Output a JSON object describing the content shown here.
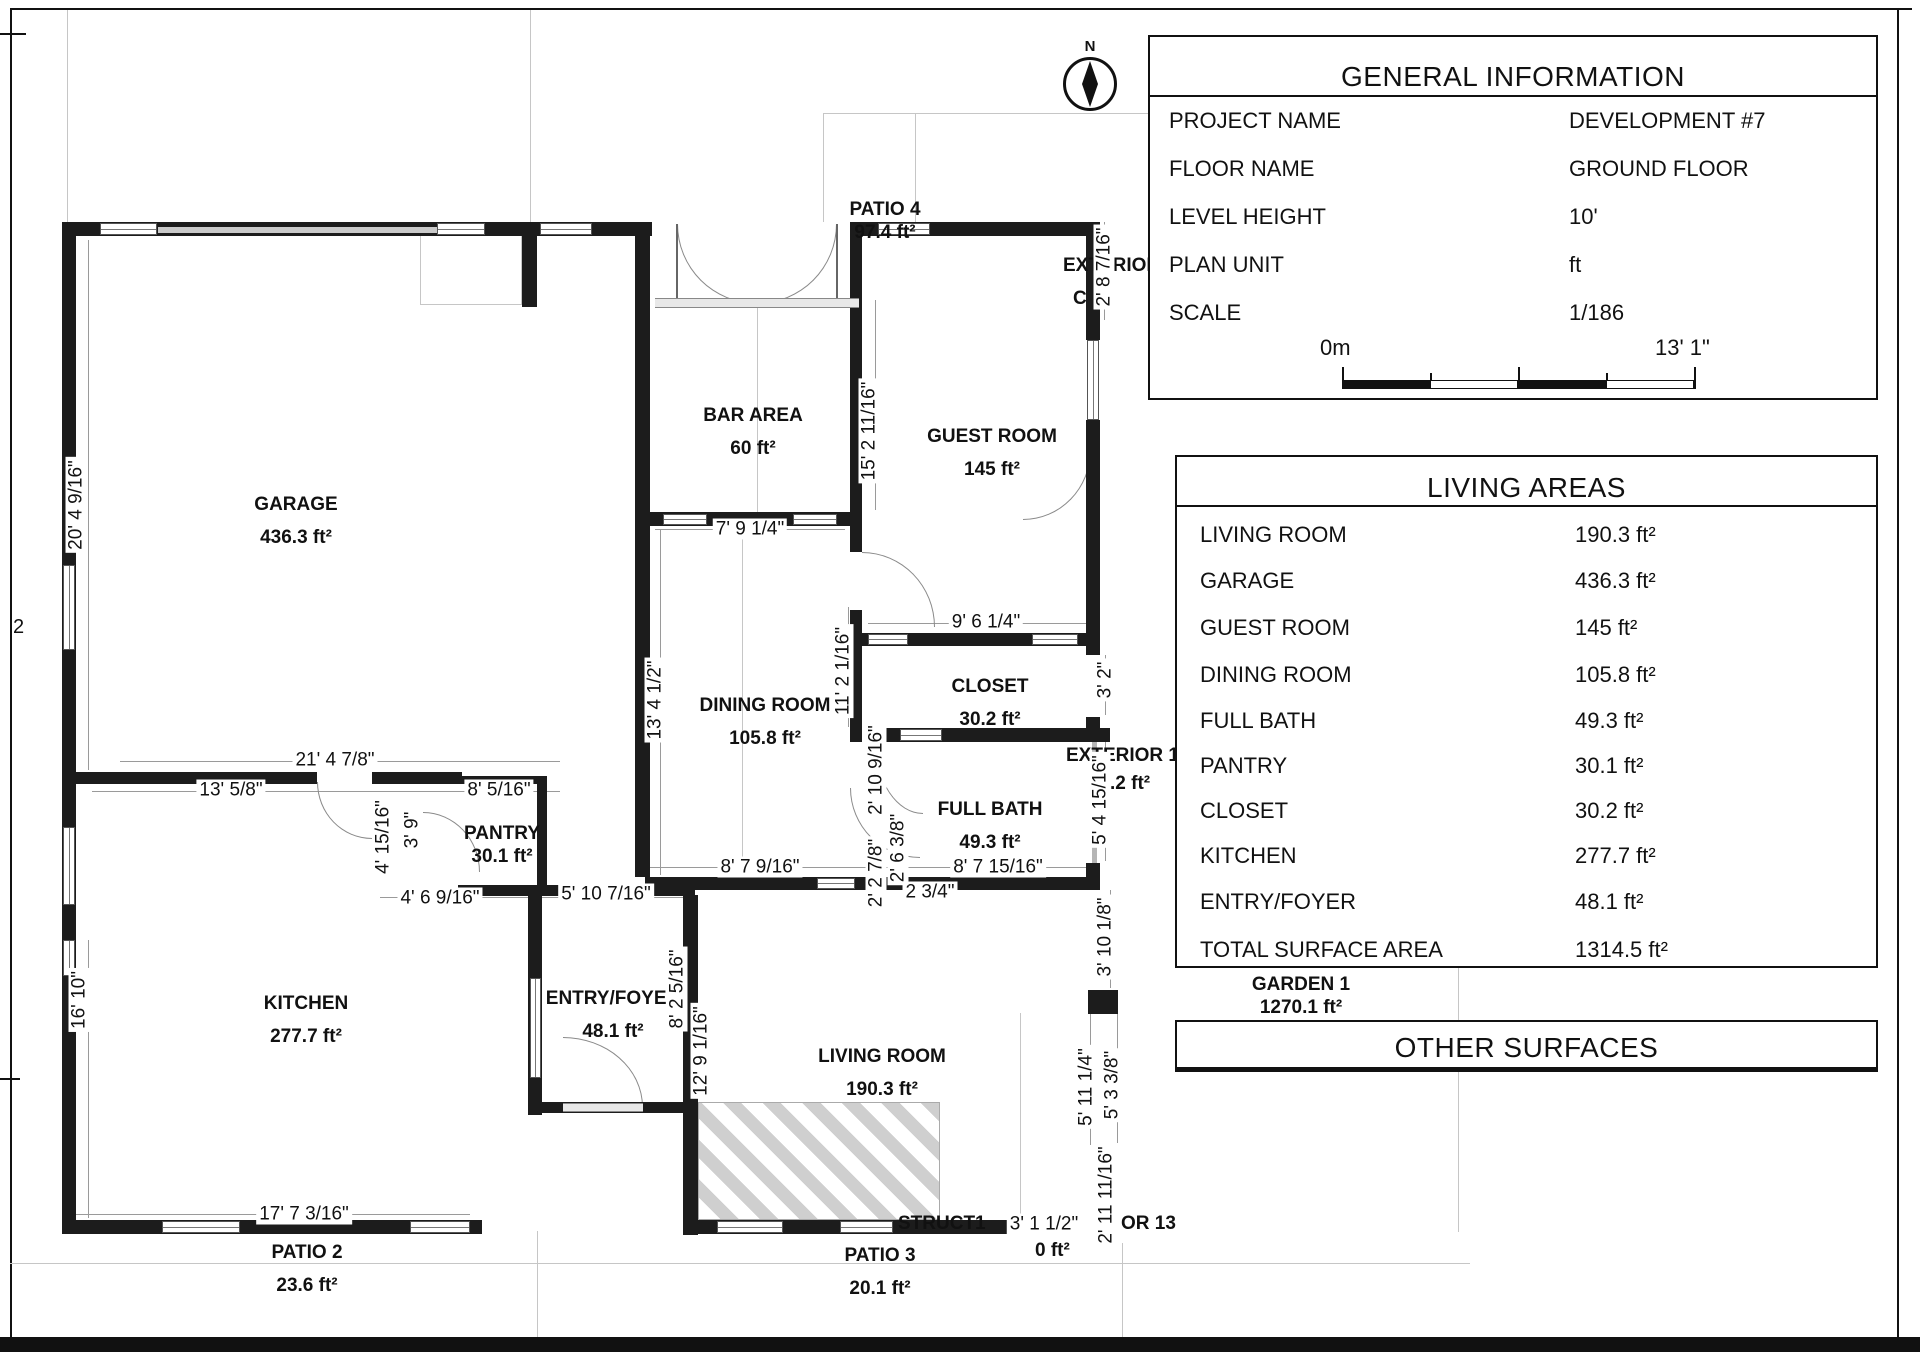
{
  "page": {
    "left_edge_label": "2"
  },
  "compass": {
    "north": "N"
  },
  "colors": {
    "wall_color": "#1c1c1c",
    "hatch_color": "#cfcfcf"
  },
  "general_info": {
    "title": "GENERAL INFORMATION",
    "rows": [
      {
        "label": "PROJECT NAME",
        "value": "DEVELOPMENT #7"
      },
      {
        "label": "FLOOR NAME",
        "value": "GROUND FLOOR"
      },
      {
        "label": "LEVEL HEIGHT",
        "value": "10'"
      },
      {
        "label": "PLAN UNIT",
        "value": "ft"
      },
      {
        "label": "SCALE",
        "value": "1/186"
      }
    ],
    "scale_bar": {
      "start": "0m",
      "end": "13' 1\""
    }
  },
  "living_areas": {
    "title": "LIVING AREAS",
    "rows": [
      {
        "label": "LIVING ROOM",
        "value": "190.3 ft²"
      },
      {
        "label": "GARAGE",
        "value": "436.3 ft²"
      },
      {
        "label": "GUEST ROOM",
        "value": "145 ft²"
      },
      {
        "label": "DINING ROOM",
        "value": "105.8 ft²"
      },
      {
        "label": "FULL BATH",
        "value": "49.3 ft²"
      },
      {
        "label": "PANTRY",
        "value": "30.1 ft²"
      },
      {
        "label": "CLOSET",
        "value": "30.2 ft²"
      },
      {
        "label": "KITCHEN",
        "value": "277.7 ft²"
      },
      {
        "label": "ENTRY/FOYER",
        "value": "48.1 ft²"
      },
      {
        "label": "TOTAL SURFACE AREA",
        "value": "1314.5 ft²"
      }
    ]
  },
  "other_surfaces": {
    "title": "OTHER SURFACES"
  },
  "site": {
    "garden_name": "GARDEN 1",
    "garden_area": "1270.1 ft²"
  },
  "rooms": {
    "garage": {
      "name": "GARAGE",
      "area": "436.3 ft²"
    },
    "bar": {
      "name": "BAR AREA",
      "area": "60 ft²"
    },
    "patio4": {
      "name": "PATIO 4",
      "area": "97.4 ft²"
    },
    "guest": {
      "name": "GUEST ROOM",
      "area": "145 ft²"
    },
    "dining": {
      "name": "DINING ROOM",
      "area": "105.8 ft²"
    },
    "closet": {
      "name": "CLOSET",
      "area": "30.2 ft²"
    },
    "fullbath": {
      "name": "FULL BATH",
      "area": "49.3 ft²"
    },
    "pantry": {
      "name": "PANTRY",
      "area": "30.1 ft²"
    },
    "kitchen": {
      "name": "KITCHEN",
      "area": "277.7 ft²"
    },
    "entry": {
      "name": "ENTRY/FOYER",
      "area": "48.1 ft²"
    },
    "living": {
      "name": "LIVING ROOM",
      "area": "190.3 ft²"
    },
    "patio2": {
      "name": "PATIO 2",
      "area": "23.6 ft²"
    },
    "patio3": {
      "name": "PATIO 3",
      "area": "20.1 ft²"
    }
  },
  "fragments": {
    "exterior_top": "EXTERIOR 1",
    "partial_c": "C",
    "exterior_mid": "EXTERIOR 1",
    "exterior_mid_area": ".2 ft²",
    "struct": "STRUCT1",
    "struct_area": "0 ft²",
    "door13": "OR 13"
  },
  "dims": [
    "7' 9 1/4\"",
    "9' 6 1/4\"",
    "21' 4 7/8\"",
    "13' 5/8\"",
    "8' 5/16\"",
    "4' 15/16\"",
    "3' 9\"",
    "4' 6 9/16\"",
    "5' 10 7/16\"",
    "8' 7 9/16\"",
    "8' 7 15/16\"",
    "2 3/4\"",
    "2' 10 9/16\"",
    "2' 2 7/8\"",
    "2' 6 3/8\"",
    "17' 7 3/16\"",
    "3' 1 1/2\"",
    "20' 4 9/16\"",
    "16' 10\"",
    "15' 2 11/16\"",
    "13' 4 1/2\"",
    "11' 2 1/16\"",
    "8' 2 5/16\"",
    "12' 9 1/16\"",
    "2' 8 7/16\"",
    "3' 2\"",
    "5' 4 15/16\"",
    "3' 10 1/8\"",
    "5' 11 1/4\"",
    "5' 3 3/8\"",
    "2' 11 11/16\""
  ]
}
